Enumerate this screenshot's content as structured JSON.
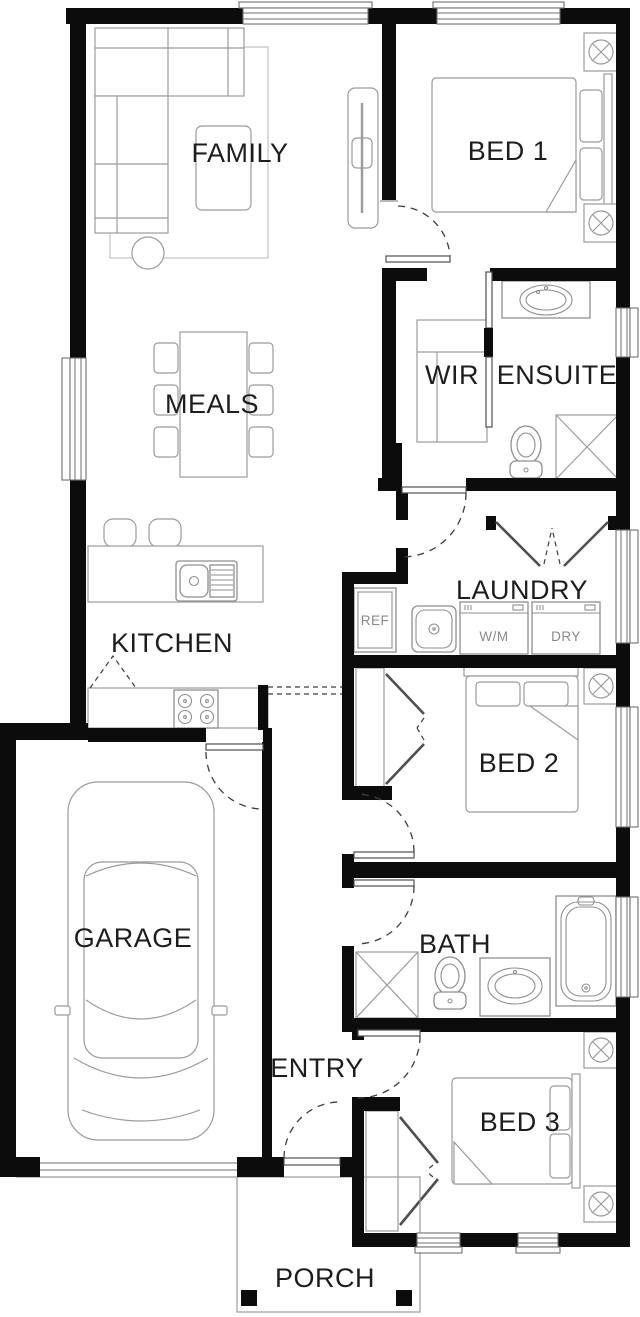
{
  "plan_title": "Single storey house floor plan",
  "rooms": [
    {
      "id": "family",
      "label": "FAMILY"
    },
    {
      "id": "bed1",
      "label": "BED 1"
    },
    {
      "id": "wir",
      "label": "WIR"
    },
    {
      "id": "ensuite",
      "label": "ENSUITE"
    },
    {
      "id": "meals",
      "label": "MEALS"
    },
    {
      "id": "laundry",
      "label": "LAUNDRY"
    },
    {
      "id": "kitchen",
      "label": "KITCHEN"
    },
    {
      "id": "bed2",
      "label": "BED 2"
    },
    {
      "id": "garage",
      "label": "GARAGE"
    },
    {
      "id": "bath",
      "label": "BATH"
    },
    {
      "id": "entry",
      "label": "ENTRY"
    },
    {
      "id": "bed3",
      "label": "BED 3"
    },
    {
      "id": "porch",
      "label": "PORCH"
    }
  ],
  "appliances": [
    {
      "id": "ref",
      "label": "REF"
    },
    {
      "id": "wm",
      "label": "W/M"
    },
    {
      "id": "dry",
      "label": "DRY"
    }
  ],
  "colors": {
    "wall": "#0c0c0c",
    "furniture_line": "#9b9b9b",
    "fixture_line": "#8f8f8f",
    "room_label": "#1d1d1d",
    "appliance_label": "#8a8a8a",
    "door_swing": "#3d3d3d",
    "background": "#ffffff"
  }
}
